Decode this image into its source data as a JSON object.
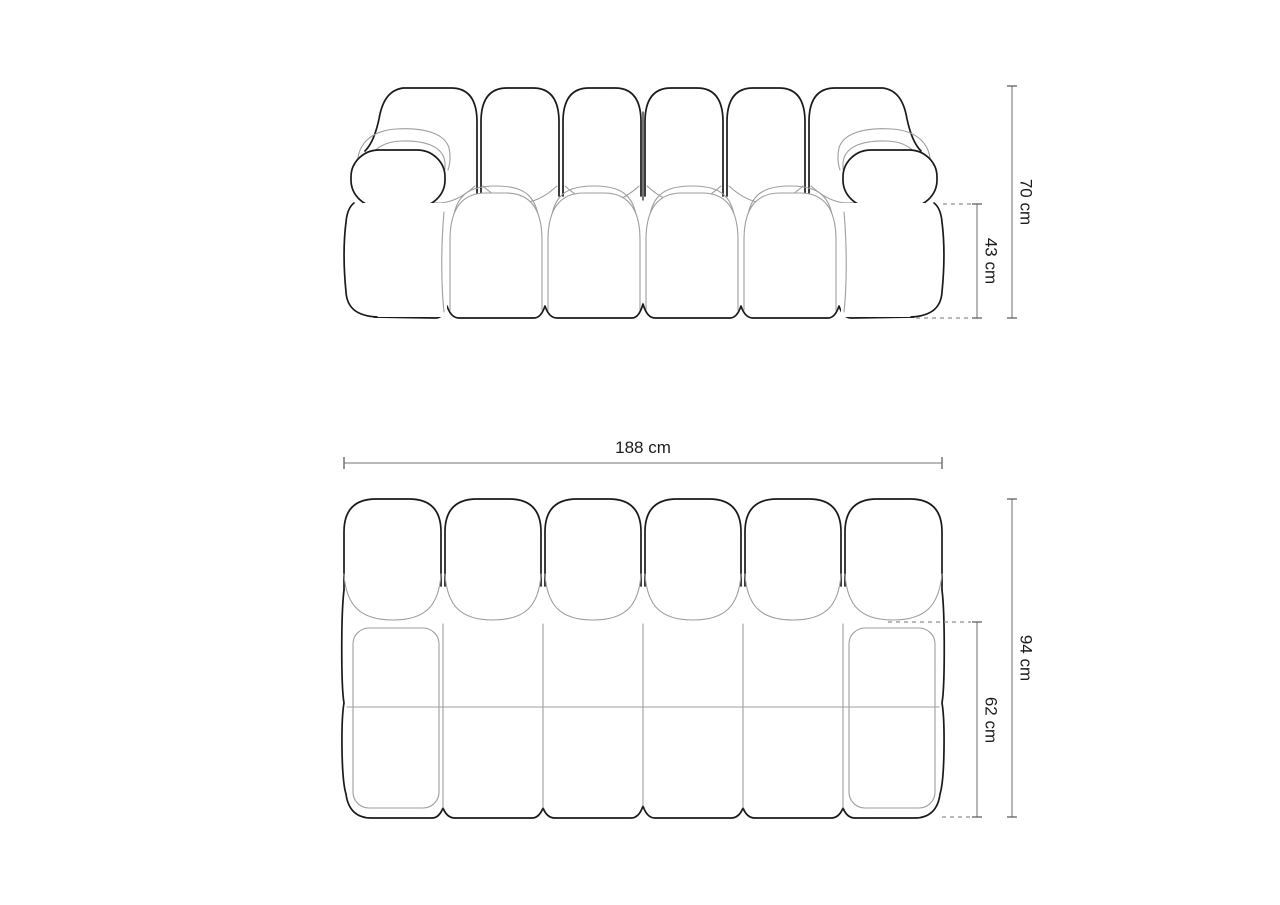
{
  "page": {
    "background": "#ffffff"
  },
  "colors": {
    "outline": "#1a1a1a",
    "seam": "#9e9e9e",
    "dimension_line": "#8f8f8f",
    "tick": "#606060",
    "label_text": "#1c1c1c"
  },
  "front_view": {
    "dimensions": {
      "overall_height": "70 cm",
      "seat_height": "43 cm"
    }
  },
  "top_view": {
    "dimensions": {
      "overall_width": "188 cm",
      "overall_depth": "94 cm",
      "seat_depth": "62 cm"
    }
  }
}
